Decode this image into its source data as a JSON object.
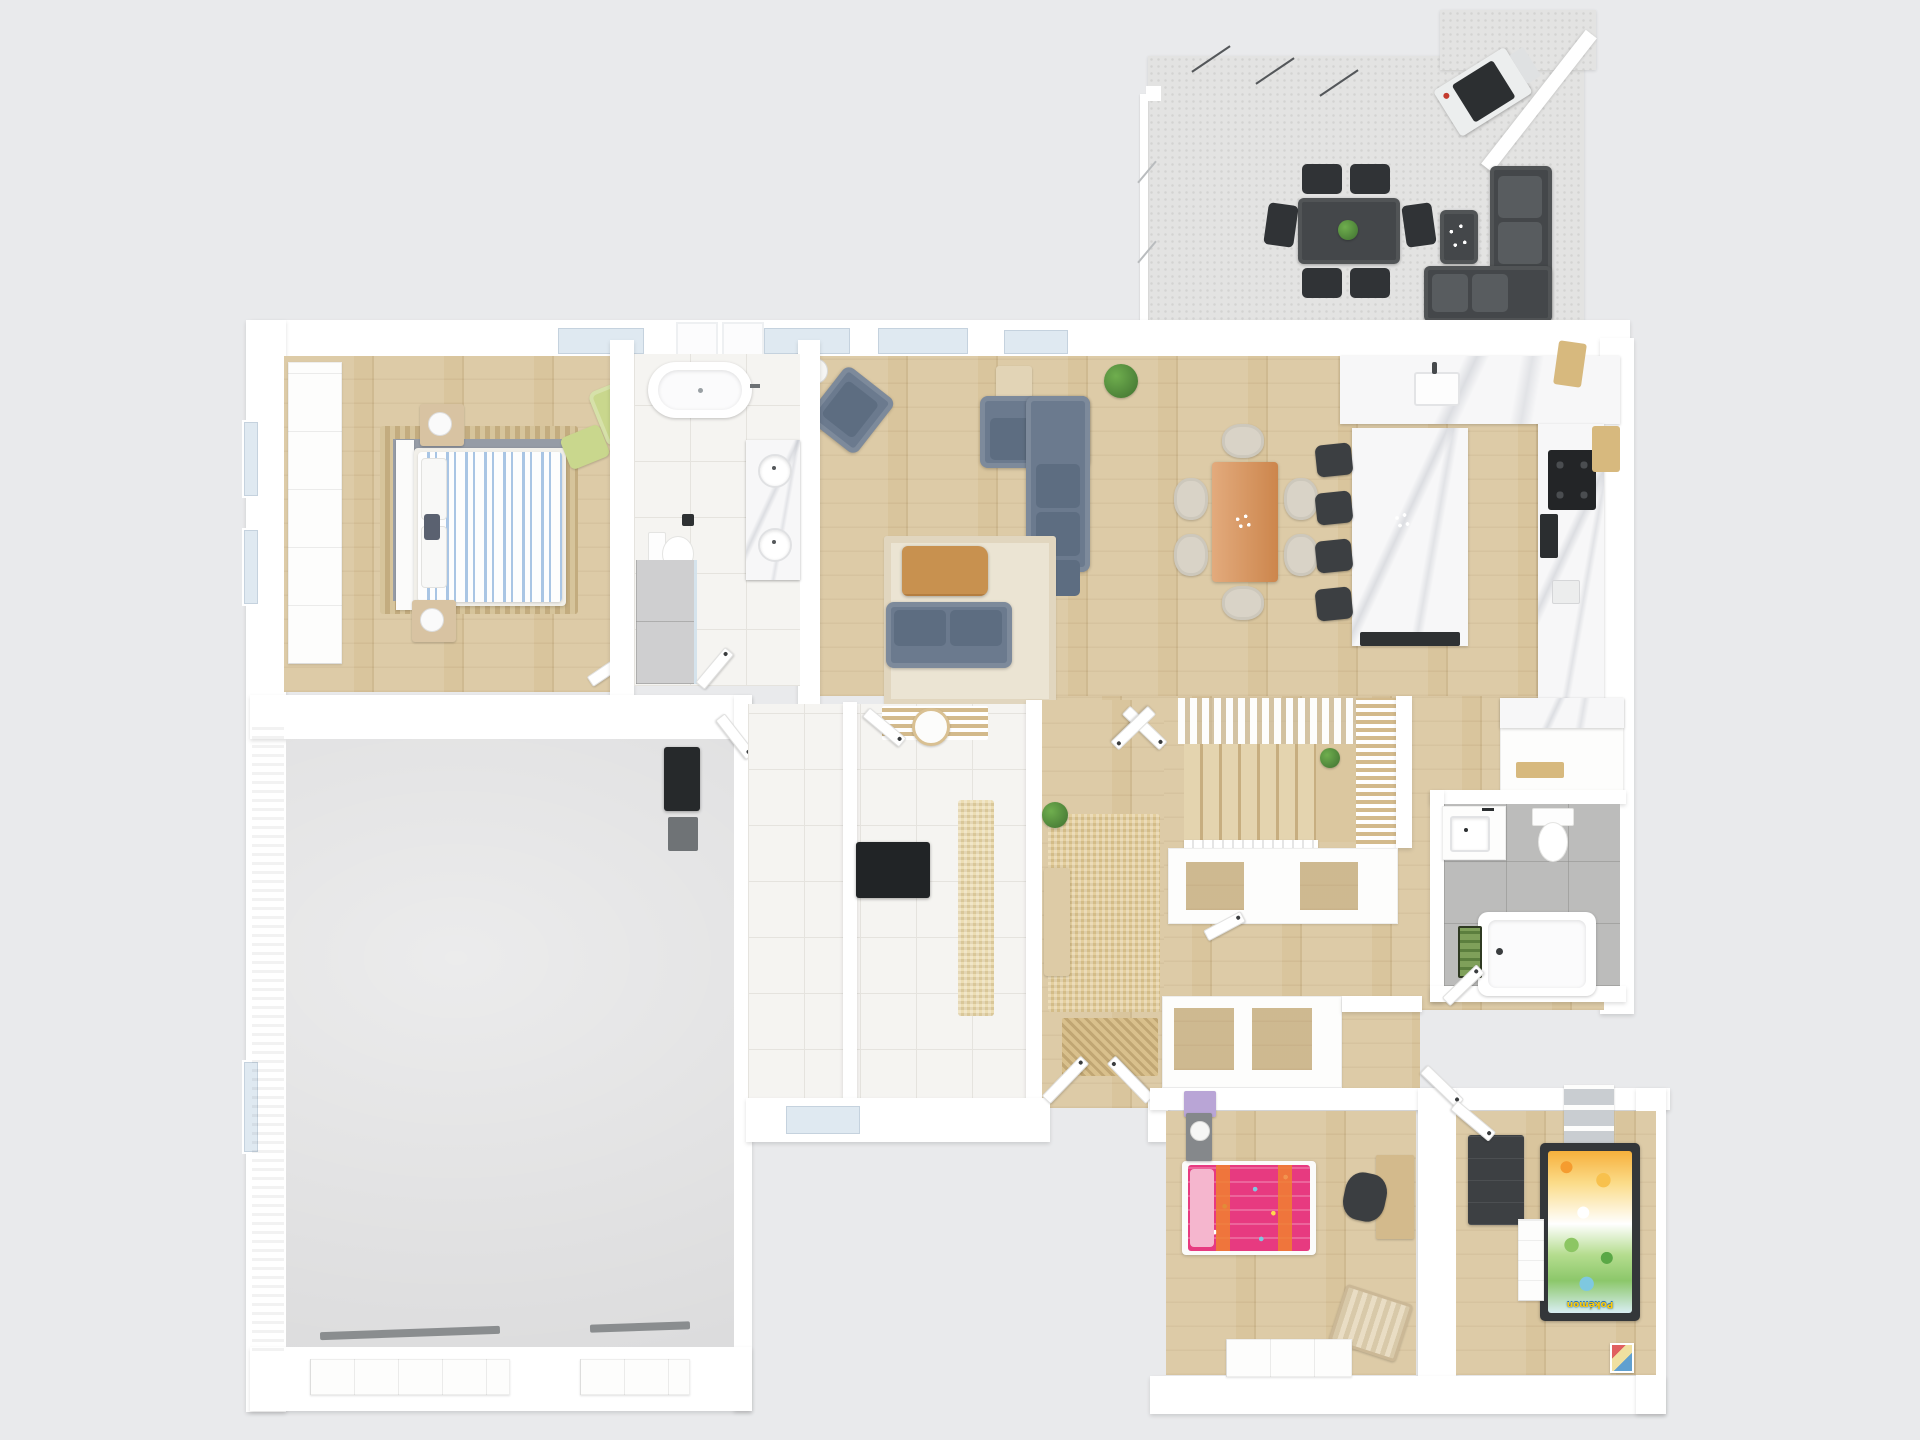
{
  "title": "3D Floor Plan Render - Single Storey Home",
  "labels": {
    "pokemon_duvet_text": "Pokémon"
  },
  "colors": {
    "bg": "#e9eaec",
    "wall": "#ffffff",
    "wood": "#d9c59d",
    "wood-dark": "#c9b184",
    "wood-slat": "#d3ba8c",
    "tile": "#f5f4f1",
    "tile-line": "#e5e3de",
    "gray-tile": "#bcbcbb",
    "concrete": "#dcdcdd",
    "gravel": "#e3e3e2",
    "marble": "#f7f7f8",
    "sofa": "#6b7a8e",
    "sofa-dark": "#5d6d81",
    "outdoor": "#44474a",
    "outdoor-dark": "#303336",
    "dark-furniture": "#3c3f42",
    "rug-cream": "#ebe4d3",
    "rug-entry": "#e4cf9e",
    "rug-runner": "#ecddb3",
    "mat": "#d9c08c",
    "green-chair": "#c9d78d",
    "table-orange": "#d98e51",
    "chair-beige": "#d9d3c7",
    "stripe-blue": "#a9c5e4",
    "pink": "#e73a80",
    "pink-light": "#f5b6ce",
    "purple": "#b9a5d6",
    "glass": "#dfe9f1",
    "orange": "#f08030"
  },
  "rooms": [
    {
      "id": "patio",
      "name": "Outdoor Patio",
      "floor": "gravel"
    },
    {
      "id": "master-bedroom",
      "name": "Master Bedroom",
      "floor": "wood"
    },
    {
      "id": "ensuite-bathroom",
      "name": "Ensuite Bathroom",
      "floor": "white-tile"
    },
    {
      "id": "living-room",
      "name": "Living Room",
      "floor": "wood"
    },
    {
      "id": "dining-area",
      "name": "Dining Area",
      "floor": "wood"
    },
    {
      "id": "kitchen",
      "name": "Kitchen",
      "floor": "wood"
    },
    {
      "id": "garage",
      "name": "Garage",
      "floor": "concrete"
    },
    {
      "id": "storage-room",
      "name": "Storage Room",
      "floor": "white-tile"
    },
    {
      "id": "mudroom-laundry",
      "name": "Mudroom / Laundry",
      "floor": "white-tile"
    },
    {
      "id": "entry-hall",
      "name": "Entry Hall",
      "floor": "wood"
    },
    {
      "id": "staircase",
      "name": "Staircase",
      "floor": "wood"
    },
    {
      "id": "hallway",
      "name": "Hallway",
      "floor": "wood"
    },
    {
      "id": "family-bathroom",
      "name": "Family Bathroom",
      "floor": "gray-tile"
    },
    {
      "id": "kids-bedroom-1",
      "name": "Kids Bedroom 1",
      "floor": "wood"
    },
    {
      "id": "kids-bedroom-2",
      "name": "Kids Bedroom 2",
      "floor": "wood"
    }
  ],
  "furniture": {
    "patio": [
      "bbq-grill",
      "outdoor-dining-table",
      "outdoor-chair x6",
      "outdoor-corner-sofa",
      "outdoor-coffee-table",
      "flower-vase",
      "glass-balustrade",
      "pergola-post"
    ],
    "master-bedroom": [
      "wardrobe-row",
      "double-bed-striped-duvet",
      "pillows",
      "area-rug",
      "nightstand x2",
      "table-lamp x2",
      "green-armchair",
      "green-ottoman",
      "black-floor-lamp",
      "wall-tv",
      "side-cabinet"
    ],
    "ensuite-bathroom": [
      "freestanding-bathtub",
      "double-vanity-marble",
      "round-sink x2",
      "toilet",
      "walk-in-shower",
      "skylight x2"
    ],
    "living-room": [
      "corner-sectional-sofa",
      "gray-armchair",
      "loveseat",
      "cream-rug",
      "live-edge-coffee-table",
      "console-table",
      "potted-plant",
      "white-floor-lamp"
    ],
    "dining-area": [
      "wooden-dining-table",
      "dining-chair x6",
      "flower-centerpiece"
    ],
    "kitchen": [
      "l-shaped-marble-counter",
      "kitchen-sink",
      "cooktop-4-burner",
      "built-in-oven",
      "kitchen-island-marble",
      "bar-stool x4",
      "cutting-board x3",
      "pantry-cabinets"
    ],
    "garage": [
      "pellet-stove",
      "utility-box",
      "garage-door x2"
    ],
    "mudroom-laundry": [
      "slat-bench",
      "round-side-table",
      "black-cabinet",
      "runner-rug"
    ],
    "entry-hall": [
      "woven-rug",
      "entry-bench",
      "potted-plant",
      "doormat",
      "double-entry-door"
    ],
    "staircase": [
      "slat-canopy",
      "wood-steps",
      "landing",
      "slat-wall",
      "potted-plant",
      "railing",
      "under-stair-closets"
    ],
    "hallway": [
      "closet-row",
      "interior-door x6"
    ],
    "family-bathroom": [
      "vanity-sink",
      "toilet",
      "bathtub",
      "green-bath-mat"
    ],
    "kids-bedroom-1": [
      "single-bed-pink-duvet",
      "pink-pillow",
      "purple-dresser",
      "gray-nightstand",
      "table-lamp",
      "desk",
      "office-chair",
      "toy-basket",
      "closet"
    ],
    "kids-bedroom-2": [
      "single-bed-pokemon-duvet",
      "dark-wardrobe",
      "white-dresser",
      "cube-shelf",
      "wall-picture"
    ]
  }
}
